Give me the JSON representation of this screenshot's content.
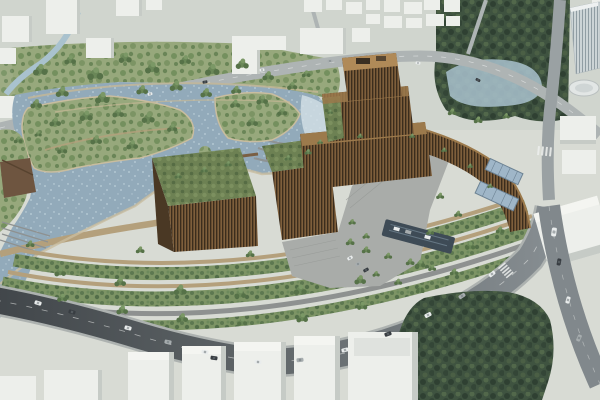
{
  "meta": {
    "title": "Aerial architectural rendering of a terraced waterfront development",
    "type": "natural-image",
    "width": 600,
    "height": 400
  },
  "scene": {
    "description": "Bird's-eye rendering: a stepped bronze ziggurat tower with green roof terraces and curved bronze wings sits between an artificial lake with islands, weirs and boardwalks (left) and concentric planted terraces that descend to a sweeping curved boulevard (bottom). White massing-model city blocks fill the top and bottom edges, dense tree massings sit at top right and bottom right, and a glass high-rise with a round podium stands at the right edge.",
    "areas": {
      "city_blocks": "white massing-model buildings with light streets",
      "canal": "small canal winding through the upper-left blocks",
      "park": "landscaped park with scattered tree clumps",
      "lake": "blue-gray lake with peninsula, island, weir arcs and rapids",
      "boardwalk": "tan pedestrian boardwalk across the water",
      "complex": "stepped bronze tower, green-roofed wings, plaza and stairs",
      "gardens": "terraced gardens with two glass greenhouses",
      "canopy": "dark parking canopy beside the complex",
      "terraces": "concentric green terrace bands with paths",
      "boulevard": "wide curved road with light traffic",
      "forest": "dense dark tree blocks at top right and bottom right",
      "tower": "glass-finned high-rise with circular white podium"
    }
  },
  "palette": {
    "water": "#92aaba",
    "waterLight": "#a9c2ce",
    "ground": "#ccd1c9",
    "groundLight": "#d8dbd4",
    "roadLight": "#aeb4b4",
    "roadMid": "#81888c",
    "roadDark": "#454a4e",
    "massing": "#edefeb",
    "massingShade": "#c6cbc6",
    "park": "#97a87c",
    "tree": "#68855a",
    "treeDark": "#4c6647",
    "forest": "#3f5340",
    "bronze": "#6b4f31",
    "bronzeDark": "#3b2d1d",
    "bronzeLight": "#9c7a4c",
    "roofGreen": "#6d8153",
    "pathTan": "#b4a07c",
    "wallGray": "#8e9190",
    "plaza": "#a9aca9",
    "canopy": "#3e4b56",
    "glass": "#9fb6c8",
    "sand": "#c9bd9f"
  }
}
